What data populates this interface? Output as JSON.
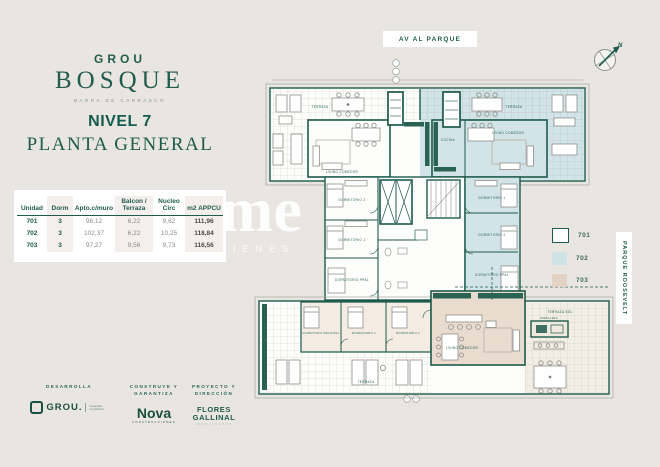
{
  "brand": {
    "top": "GROU",
    "main": "BOSQUE",
    "tagline": "BARRA DE CARRASCO"
  },
  "title": {
    "line1": "NIVEL 7",
    "line2": "PLANTA GENERAL"
  },
  "table": {
    "headers": [
      "Unidad",
      "Dorm",
      "Apto.c/muro",
      "Balcon / Terraza",
      "Nucleo Circ",
      "m2 APPCU"
    ],
    "rows": [
      [
        "701",
        "3",
        "96,12",
        "6,22",
        "9,62",
        "111,96"
      ],
      [
        "702",
        "3",
        "102,37",
        "6,22",
        "10,25",
        "118,84"
      ],
      [
        "703",
        "3",
        "97,27",
        "9,56",
        "9,73",
        "116,56"
      ]
    ]
  },
  "plan": {
    "top_label": "AV AL PARQUE",
    "side_label": "PARQUE ROOSEVELT",
    "compass": "N",
    "legend": [
      {
        "unit": "701",
        "color": "#ffffff"
      },
      {
        "unit": "702",
        "color": "#cfe3e6"
      },
      {
        "unit": "703",
        "color": "#e4d1c5"
      }
    ],
    "room_labels": {
      "terraza": "TERRAZA",
      "terraza_sol": "TERRAZA SOL",
      "living": "LIVING COMEDOR",
      "cocina": "COCINA",
      "dorm_ppal": "DORMITORIO PPAL",
      "dorm_principal": "DORMITORIO PRINCIPAL",
      "dorm1": "DORMITORIO 1",
      "dorm2": "DORMITORIO 2",
      "parrillero": "PARRILLERO"
    },
    "wall_color": "#1d5a4b",
    "unit_702_fill": "#d2e4e7",
    "unit_703_fill": "#e9dccf"
  },
  "watermark": {
    "big": "me",
    "small": "BIENES"
  },
  "footer": {
    "blocks": [
      {
        "role": "DESARROLLA",
        "logo": "GROU.",
        "logo_sub": "Desarrollos inmobiliarios"
      },
      {
        "role": "CONSTRUYE Y GARANTIZA",
        "logo": "Nova",
        "logo_sub": "CONSTRUCCIONES"
      },
      {
        "role": "PROYECTO Y DIRECCIÓN",
        "logo_line1": "FLORES",
        "logo_line2": "GALLINAL",
        "logo_sub": "ARQUITECTOS"
      }
    ]
  }
}
